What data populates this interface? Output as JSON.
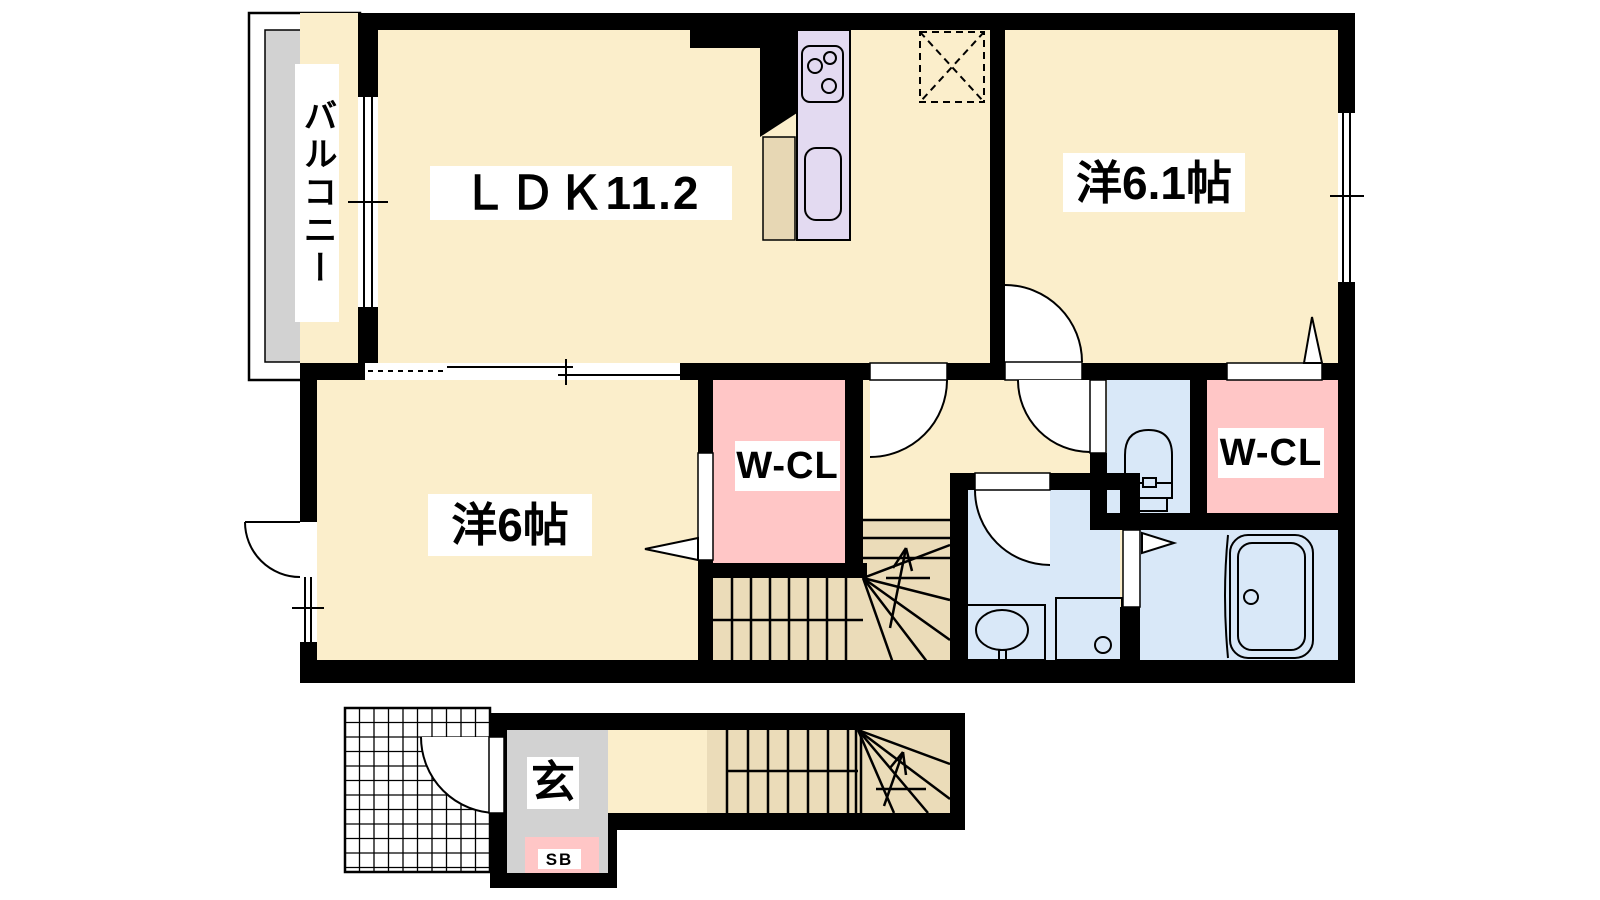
{
  "plan": {
    "type": "japanese-apartment-floor-plan",
    "floor_summary": "2LDK maisonette: LDK 11.2, western room 6.1 jo, western room 6 jo, 2 walk-in closets, bathroom, toilet, washroom, balcony, entrance with shoe box and internal staircase",
    "labels": {
      "balcony": "バルコニー",
      "ldk": "ＬＤＫ11.2",
      "western_room_61": "洋6.1帖",
      "western_room_6": "洋6帖",
      "walk_in_closet_1": "W-CL",
      "walk_in_closet_2": "W-CL",
      "entrance": "玄",
      "shoe_box": "SB"
    },
    "colors": {
      "paper-white": "#FFFFFF",
      "wall-black": "#000000",
      "floor-cream": "#FBEECB",
      "stairs-tan": "#EBDCB9",
      "closet-pink": "#FFC6C6",
      "sanitary-blue": "#D9E8F8",
      "balcony-gray": "#D2D2D2",
      "kitchen-lavender": "#E3DAF1",
      "counter-tan": "#E7D7B4"
    },
    "rooms": [
      {
        "name": "ldk",
        "size_tatami": 11.2
      },
      {
        "name": "western-room",
        "size_tatami": 6.1
      },
      {
        "name": "western-room",
        "size_tatami": 6.0
      },
      {
        "name": "walk-in-closet",
        "count": 2
      },
      {
        "name": "toilet"
      },
      {
        "name": "washroom"
      },
      {
        "name": "bathroom"
      },
      {
        "name": "balcony"
      },
      {
        "name": "entrance"
      },
      {
        "name": "staircase"
      }
    ]
  }
}
